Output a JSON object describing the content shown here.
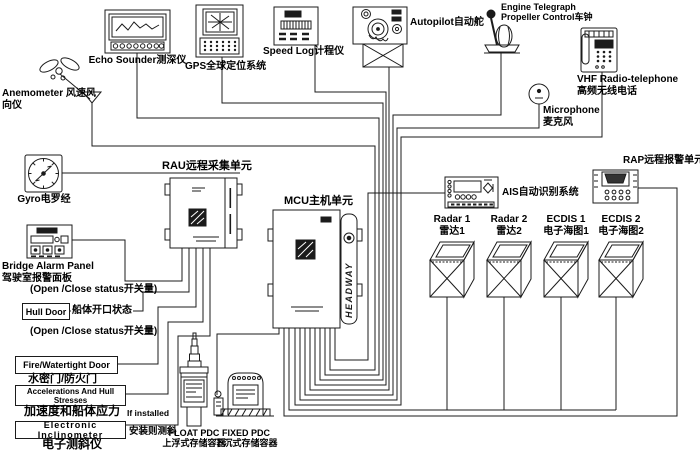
{
  "colors": {
    "line": "#1b1b1b",
    "ink": "#000000",
    "background": "#ffffff"
  },
  "devices": {
    "anemometer": {
      "line1": "Anemometer 风速风",
      "line2": "向仪"
    },
    "echo_sounder": {
      "label": "Echo Sounder测深仪"
    },
    "gps": {
      "label": "GPS全球定位系统"
    },
    "speed_log": {
      "label": "Speed Log计程仪"
    },
    "autopilot": {
      "label": "Autopilot自动舵"
    },
    "engine_telegraph": {
      "line1": "Engine Telegraph",
      "line2": "Propeller Control车钟"
    },
    "vhf": {
      "line1": "VHF Radio-telephone",
      "line2": "高频无线电话"
    },
    "microphone": {
      "line1": "Microphone",
      "line2": "麦克风"
    },
    "gyro": {
      "label": "Gyro电罗经"
    },
    "rau": {
      "label": "RAU远程采集单元"
    },
    "mcu": {
      "label": "MCU主机单元",
      "brand": "HEADWAY"
    },
    "bridge_alarm_panel": {
      "line1": "Bridge Alarm Panel",
      "line2": "驾驶室报警面板",
      "note": "(Open /Close status开关量)"
    },
    "hull_door": {
      "box": "Hull Door",
      "side": "船体开口状态",
      "note": "(Open /Close status开关量)"
    },
    "fire_door": {
      "box": "Fire/Watertight Door",
      "below": "水密门/防火门"
    },
    "accelerations": {
      "box": "Accelerations And Hull Stresses",
      "below": "加速度和船体应力"
    },
    "inclinometer": {
      "box": "Electronic Inclinometer",
      "below": "电子测斜仪",
      "note1": "If installed",
      "note2": "安装则测斜"
    },
    "float_pdc": {
      "line1": "FLOAT PDC",
      "line2": "上浮式存储容器"
    },
    "fixed_pdc": {
      "line1": "FIXED PDC",
      "line2": "下沉式存储容器"
    },
    "ais": {
      "label": "AIS自动识别系统"
    },
    "rap": {
      "label": "RAP远程报警单元"
    },
    "radar1": {
      "line1": "Radar 1",
      "line2": "雷达1"
    },
    "radar2": {
      "line1": "Radar 2",
      "line2": "雷达2"
    },
    "ecdis1": {
      "line1": "ECDIS 1",
      "line2": "电子海图1"
    },
    "ecdis2": {
      "line1": "ECDIS 2",
      "line2": "电子海图2"
    }
  }
}
